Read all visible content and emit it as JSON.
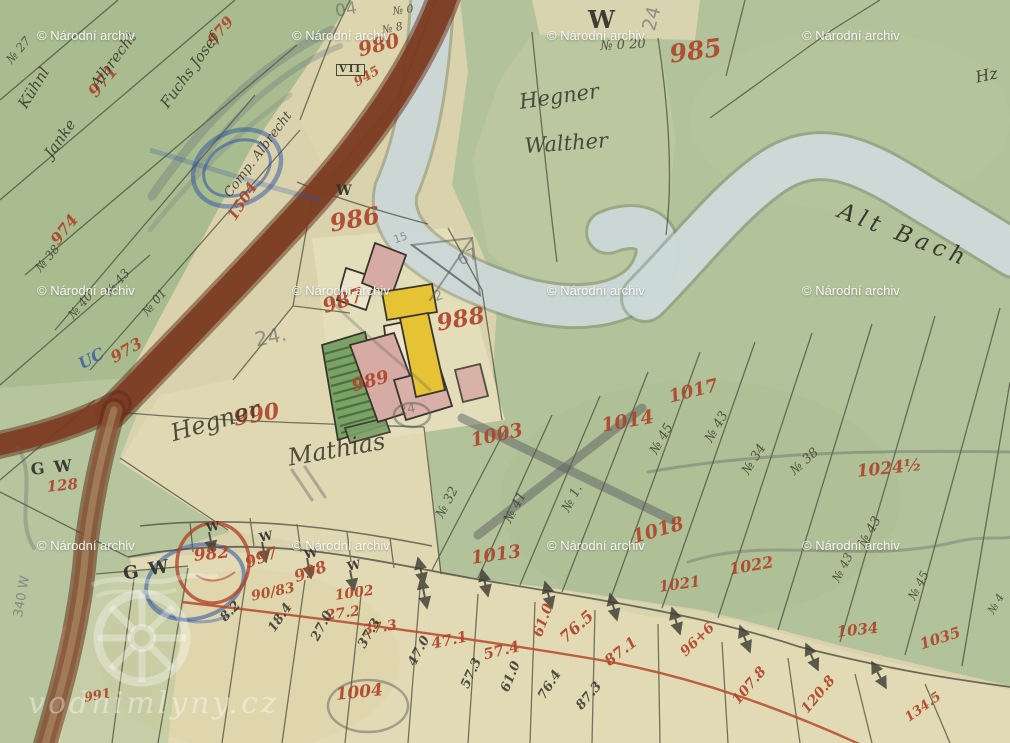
{
  "meta": {
    "archive_watermark": "© Národní archiv",
    "logo_watermark": "vodnimlyny.cz"
  },
  "watermark_positions": [
    [
      37,
      28
    ],
    [
      292,
      28
    ],
    [
      547,
      28
    ],
    [
      802,
      28
    ],
    [
      37,
      283
    ],
    [
      292,
      283
    ],
    [
      547,
      283
    ],
    [
      802,
      283
    ],
    [
      37,
      538
    ],
    [
      292,
      538
    ],
    [
      547,
      538
    ],
    [
      802,
      538
    ]
  ],
  "colors": {
    "paper_beige": "#d9d2ad",
    "field_green": "#b2c29a",
    "stream_blue": "#cdd9d9",
    "road_brown": "#7d3c22",
    "parcel_red": "#ae452a",
    "stamp_blue": "#2c52a2",
    "building_pink": "#d6aba3",
    "building_yellow": "#e5c335"
  },
  "stream_label": "Alt Bach",
  "annotations": [
    {
      "t": "Alt Bach",
      "x": 843,
      "y": 200,
      "r": 21,
      "s": 23,
      "c": "bach"
    },
    {
      "t": "971",
      "x": 86,
      "y": 90,
      "r": -50,
      "s": 17,
      "c": "red"
    },
    {
      "t": "979",
      "x": 205,
      "y": 38,
      "r": -50,
      "s": 15,
      "c": "red"
    },
    {
      "t": "974",
      "x": 48,
      "y": 238,
      "r": -52,
      "s": 16,
      "c": "red"
    },
    {
      "t": "973",
      "x": 108,
      "y": 352,
      "r": -30,
      "s": 16,
      "c": "red"
    },
    {
      "t": "1504",
      "x": 225,
      "y": 215,
      "r": -57,
      "s": 15,
      "c": "red"
    },
    {
      "t": "945",
      "x": 352,
      "y": 78,
      "r": -30,
      "s": 13,
      "c": "red"
    },
    {
      "t": "980",
      "x": 356,
      "y": 40,
      "r": -14,
      "s": 20,
      "c": "red"
    },
    {
      "t": "985",
      "x": 668,
      "y": 42,
      "r": -8,
      "s": 25,
      "c": "red"
    },
    {
      "t": "986",
      "x": 328,
      "y": 212,
      "r": -10,
      "s": 24,
      "c": "red"
    },
    {
      "t": "987",
      "x": 320,
      "y": 297,
      "r": -18,
      "s": 20,
      "c": "red"
    },
    {
      "t": "988",
      "x": 435,
      "y": 312,
      "r": -10,
      "s": 23,
      "c": "red"
    },
    {
      "t": "989",
      "x": 350,
      "y": 378,
      "r": -15,
      "s": 18,
      "c": "red"
    },
    {
      "t": "990",
      "x": 232,
      "y": 408,
      "r": -10,
      "s": 22,
      "c": "red"
    },
    {
      "t": "128",
      "x": 46,
      "y": 480,
      "r": -6,
      "s": 15,
      "c": "red"
    },
    {
      "t": "982",
      "x": 193,
      "y": 548,
      "r": -6,
      "s": 17,
      "c": "red"
    },
    {
      "t": "997",
      "x": 243,
      "y": 556,
      "r": -20,
      "s": 16,
      "c": "red"
    },
    {
      "t": "998",
      "x": 292,
      "y": 570,
      "r": -20,
      "s": 16,
      "c": "red"
    },
    {
      "t": "90/83",
      "x": 250,
      "y": 590,
      "r": -12,
      "s": 14,
      "c": "red"
    },
    {
      "t": "1002",
      "x": 334,
      "y": 589,
      "r": -8,
      "s": 14,
      "c": "red"
    },
    {
      "t": "991",
      "x": 83,
      "y": 692,
      "r": -10,
      "s": 13,
      "c": "red"
    },
    {
      "t": "1003",
      "x": 469,
      "y": 432,
      "r": -12,
      "s": 19,
      "c": "red"
    },
    {
      "t": "1004",
      "x": 335,
      "y": 687,
      "r": -6,
      "s": 17,
      "c": "red"
    },
    {
      "t": "1013",
      "x": 470,
      "y": 550,
      "r": -8,
      "s": 18,
      "c": "red"
    },
    {
      "t": "1014",
      "x": 600,
      "y": 417,
      "r": -10,
      "s": 19,
      "c": "red"
    },
    {
      "t": "1017",
      "x": 667,
      "y": 389,
      "r": -14,
      "s": 18,
      "c": "red"
    },
    {
      "t": "1018",
      "x": 630,
      "y": 529,
      "r": -16,
      "s": 19,
      "c": "red"
    },
    {
      "t": "1021",
      "x": 658,
      "y": 580,
      "r": -8,
      "s": 15,
      "c": "red"
    },
    {
      "t": "1022",
      "x": 728,
      "y": 562,
      "r": -10,
      "s": 16,
      "c": "red"
    },
    {
      "t": "1024½",
      "x": 856,
      "y": 464,
      "r": -6,
      "s": 17,
      "c": "red"
    },
    {
      "t": "1034",
      "x": 836,
      "y": 625,
      "r": -6,
      "s": 15,
      "c": "red"
    },
    {
      "t": "1035",
      "x": 918,
      "y": 638,
      "r": -18,
      "s": 15,
      "c": "red"
    },
    {
      "t": "27.2",
      "x": 325,
      "y": 609,
      "r": -8,
      "s": 14,
      "c": "red"
    },
    {
      "t": "37.3",
      "x": 362,
      "y": 624,
      "r": -10,
      "s": 14,
      "c": "red"
    },
    {
      "t": "47.1",
      "x": 430,
      "y": 637,
      "r": -12,
      "s": 15,
      "c": "red"
    },
    {
      "t": "57.4",
      "x": 482,
      "y": 648,
      "r": -14,
      "s": 15,
      "c": "red"
    },
    {
      "t": "61.0",
      "x": 531,
      "y": 634,
      "r": -70,
      "s": 14,
      "c": "red"
    },
    {
      "t": "76.5",
      "x": 557,
      "y": 634,
      "r": -42,
      "s": 16,
      "c": "red"
    },
    {
      "t": "87.1",
      "x": 602,
      "y": 657,
      "r": -38,
      "s": 15,
      "c": "red"
    },
    {
      "t": "96+6",
      "x": 678,
      "y": 649,
      "r": -44,
      "s": 14,
      "c": "red"
    },
    {
      "t": "107.8",
      "x": 730,
      "y": 698,
      "r": -50,
      "s": 14,
      "c": "red"
    },
    {
      "t": "120.8",
      "x": 799,
      "y": 707,
      "r": -50,
      "s": 14,
      "c": "red"
    },
    {
      "t": "134.5",
      "x": 903,
      "y": 714,
      "r": -36,
      "s": 13,
      "c": "red"
    },
    {
      "t": "8.2",
      "x": 218,
      "y": 615,
      "r": -45,
      "s": 13,
      "c": "ink"
    },
    {
      "t": "18.4",
      "x": 266,
      "y": 627,
      "r": -55,
      "s": 13,
      "c": "ink"
    },
    {
      "t": "27.0",
      "x": 309,
      "y": 637,
      "r": -62,
      "s": 13,
      "c": "ink"
    },
    {
      "t": "37.3",
      "x": 356,
      "y": 644,
      "r": -60,
      "s": 13,
      "c": "ink"
    },
    {
      "t": "47.0",
      "x": 406,
      "y": 662,
      "r": -62,
      "s": 13,
      "c": "ink"
    },
    {
      "t": "57.3",
      "x": 459,
      "y": 685,
      "r": -65,
      "s": 13,
      "c": "ink"
    },
    {
      "t": "61.0",
      "x": 499,
      "y": 689,
      "r": -68,
      "s": 13,
      "c": "ink"
    },
    {
      "t": "76.4",
      "x": 536,
      "y": 695,
      "r": -58,
      "s": 13,
      "c": "ink"
    },
    {
      "t": "87.3",
      "x": 574,
      "y": 704,
      "r": -50,
      "s": 13,
      "c": "ink"
    },
    {
      "t": "Kühnl",
      "x": 16,
      "y": 103,
      "r": -58,
      "s": 15,
      "c": "hand"
    },
    {
      "t": "Janke",
      "x": 42,
      "y": 152,
      "r": -55,
      "s": 15,
      "c": "hand"
    },
    {
      "t": "Albrecht",
      "x": 88,
      "y": 82,
      "r": -53,
      "s": 15,
      "c": "hand"
    },
    {
      "t": "Fuchs Josef",
      "x": 158,
      "y": 102,
      "r": -54,
      "s": 15,
      "c": "hand"
    },
    {
      "t": "Comp. Albrecht",
      "x": 222,
      "y": 192,
      "r": -53,
      "s": 13,
      "c": "hand"
    },
    {
      "t": "Hegner",
      "x": 518,
      "y": 92,
      "r": -8,
      "s": 21,
      "c": "hand"
    },
    {
      "t": "Walther",
      "x": 524,
      "y": 136,
      "r": -4,
      "s": 21,
      "c": "hand"
    },
    {
      "t": "Hegner",
      "x": 168,
      "y": 422,
      "r": -16,
      "s": 24,
      "c": "hand"
    },
    {
      "t": "Mathias",
      "x": 286,
      "y": 446,
      "r": -10,
      "s": 24,
      "c": "hand"
    },
    {
      "t": "Hz",
      "x": 974,
      "y": 70,
      "r": -12,
      "s": 16,
      "c": "hand"
    },
    {
      "t": "№ 27",
      "x": 4,
      "y": 58,
      "r": -50,
      "s": 12,
      "c": "script"
    },
    {
      "t": "№ 38",
      "x": 33,
      "y": 266,
      "r": -50,
      "s": 12,
      "c": "script"
    },
    {
      "t": "№ 40",
      "x": 66,
      "y": 313,
      "r": -50,
      "s": 12,
      "c": "script"
    },
    {
      "t": "№ 43",
      "x": 103,
      "y": 290,
      "r": -50,
      "s": 12,
      "c": "script"
    },
    {
      "t": "№ 01",
      "x": 140,
      "y": 310,
      "r": -50,
      "s": 12,
      "c": "script"
    },
    {
      "t": "№ 0",
      "x": 392,
      "y": 6,
      "r": -8,
      "s": 11,
      "c": "script"
    },
    {
      "t": "№ 8",
      "x": 381,
      "y": 25,
      "r": -12,
      "s": 11,
      "c": "script"
    },
    {
      "t": "№ 0 20",
      "x": 600,
      "y": 40,
      "r": -3,
      "s": 13,
      "c": "script"
    },
    {
      "t": "№ 32",
      "x": 434,
      "y": 514,
      "r": -62,
      "s": 13,
      "c": "script"
    },
    {
      "t": "№ 41",
      "x": 502,
      "y": 519,
      "r": -62,
      "s": 13,
      "c": "script"
    },
    {
      "t": "№ 1.",
      "x": 560,
      "y": 508,
      "r": -62,
      "s": 13,
      "c": "script"
    },
    {
      "t": "№ 45",
      "x": 648,
      "y": 450,
      "r": -60,
      "s": 13,
      "c": "script"
    },
    {
      "t": "№ 43",
      "x": 703,
      "y": 438,
      "r": -60,
      "s": 13,
      "c": "script"
    },
    {
      "t": "№ 34",
      "x": 740,
      "y": 470,
      "r": -58,
      "s": 13,
      "c": "script"
    },
    {
      "t": "№ 38",
      "x": 788,
      "y": 468,
      "r": -42,
      "s": 13,
      "c": "script"
    },
    {
      "t": "№ 43",
      "x": 856,
      "y": 543,
      "r": -60,
      "s": 13,
      "c": "script"
    },
    {
      "t": "№ 43",
      "x": 830,
      "y": 578,
      "r": -62,
      "s": 12,
      "c": "script"
    },
    {
      "t": "№ 45",
      "x": 906,
      "y": 596,
      "r": -62,
      "s": 12,
      "c": "script"
    },
    {
      "t": "№ 4",
      "x": 986,
      "y": 610,
      "r": -60,
      "s": 11,
      "c": "script"
    },
    {
      "t": "W",
      "x": 588,
      "y": 8,
      "r": 0,
      "s": 24,
      "c": "label"
    },
    {
      "t": "W",
      "x": 336,
      "y": 184,
      "r": 0,
      "s": 14,
      "c": "label"
    },
    {
      "t": "VII",
      "x": 336,
      "y": 64,
      "r": 0,
      "s": 10,
      "c": "label boxed"
    },
    {
      "t": "G W",
      "x": 30,
      "y": 462,
      "r": -6,
      "s": 16,
      "c": "label"
    },
    {
      "t": "G W",
      "x": 122,
      "y": 566,
      "r": -10,
      "s": 18,
      "c": "label"
    },
    {
      "t": "W",
      "x": 205,
      "y": 522,
      "r": -10,
      "s": 12,
      "c": "label"
    },
    {
      "t": "W",
      "x": 258,
      "y": 532,
      "r": -12,
      "s": 12,
      "c": "label"
    },
    {
      "t": "W",
      "x": 303,
      "y": 549,
      "r": -12,
      "s": 12,
      "c": "label"
    },
    {
      "t": "W",
      "x": 346,
      "y": 561,
      "r": -12,
      "s": 12,
      "c": "label"
    },
    {
      "t": "04",
      "x": 334,
      "y": 4,
      "r": -10,
      "s": 17,
      "c": "pencil"
    },
    {
      "t": "24",
      "x": 640,
      "y": 28,
      "r": -75,
      "s": 19,
      "c": "pencil"
    },
    {
      "t": "24.",
      "x": 253,
      "y": 330,
      "r": -12,
      "s": 20,
      "c": "pencil"
    },
    {
      "t": "24",
      "x": 398,
      "y": 405,
      "r": -10,
      "s": 13,
      "c": "pencil"
    },
    {
      "t": "15",
      "x": 392,
      "y": 235,
      "r": -20,
      "s": 11,
      "c": "pencil"
    },
    {
      "t": "67",
      "x": 455,
      "y": 254,
      "r": -25,
      "s": 16,
      "c": "pencil"
    },
    {
      "t": "2",
      "x": 432,
      "y": 291,
      "r": -20,
      "s": 14,
      "c": "pencil"
    },
    {
      "t": "340 W",
      "x": 12,
      "y": 616,
      "r": -80,
      "s": 13,
      "c": "pencil"
    },
    {
      "t": "UC",
      "x": 76,
      "y": 358,
      "r": -28,
      "s": 16,
      "c": "blue"
    }
  ]
}
